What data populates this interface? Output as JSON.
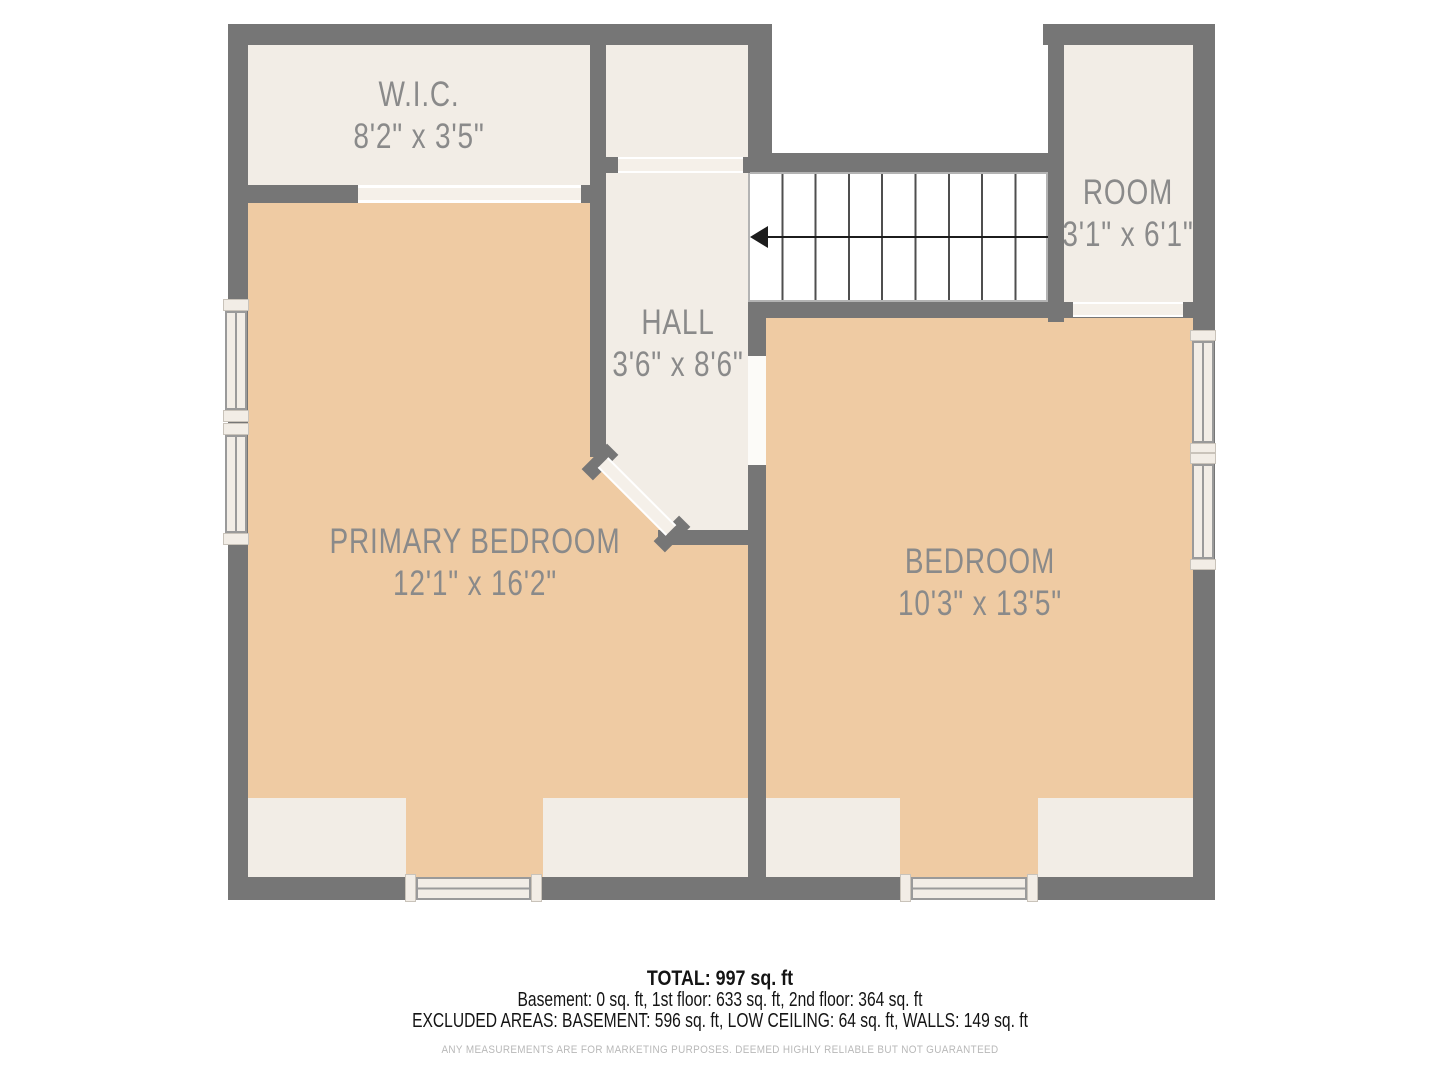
{
  "colors": {
    "wall": "#767676",
    "floor": "#efcba3",
    "cream": "#f2ede6",
    "door": "#f5f0e9",
    "opening": "#fcfbf8",
    "label": "#8a8a8a",
    "stair-line": "#4f4f4f",
    "arrow": "#1c1c1c",
    "window-line": "#9a9a9a",
    "footer-text": "#141414",
    "footer-muted": "#b8b8b8"
  },
  "rooms": {
    "wic": {
      "name": "W.I.C.",
      "dims": "8'2\" x 3'5\""
    },
    "hall": {
      "name": "HALL",
      "dims": "3'6\" x 8'6\""
    },
    "room": {
      "name": "ROOM",
      "dims": "3'1\" x 6'1\""
    },
    "primary": {
      "name": "PRIMARY BEDROOM",
      "dims": "12'1\" x 16'2\""
    },
    "bedroom": {
      "name": "BEDROOM",
      "dims": "10'3\" x 13'5\""
    }
  },
  "footer": {
    "total": "TOTAL: 997 sq. ft",
    "floors": "Basement: 0 sq. ft, 1st floor: 633 sq. ft, 2nd floor: 364 sq. ft",
    "excluded": "EXCLUDED AREAS: BASEMENT: 596 sq. ft, LOW CEILING: 64 sq. ft, WALLS: 149 sq. ft",
    "disclaimer": "ANY MEASUREMENTS ARE FOR MARKETING PURPOSES. DEEMED HIGHLY RELIABLE BUT NOT GUARANTEED"
  }
}
